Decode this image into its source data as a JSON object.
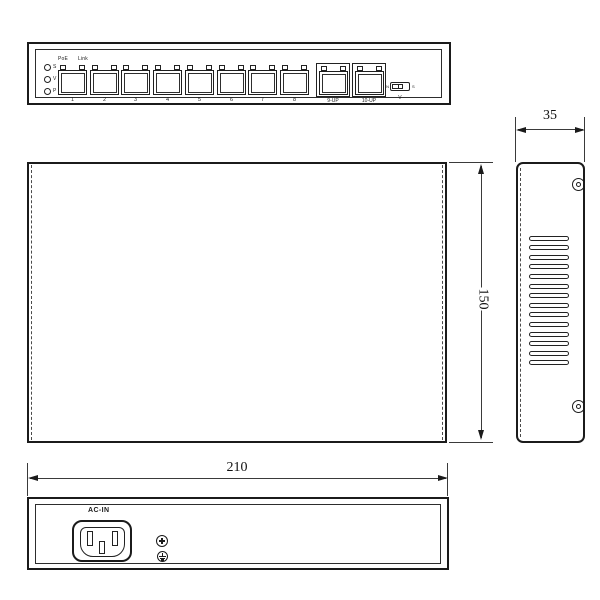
{
  "front_view": {
    "led_labels": [
      "S",
      "V",
      "P"
    ],
    "poe_label": "PoE",
    "link_label": "Link",
    "port_numbers": [
      "1",
      "2",
      "3",
      "4",
      "5",
      "6",
      "7",
      "8"
    ],
    "uplink_labels": [
      "9-UP",
      "10-UP"
    ],
    "switch": {
      "left_mark": "N",
      "right_mark": "S",
      "label": "V"
    }
  },
  "dimensions": {
    "side_width": "35",
    "top_depth": "150",
    "rear_width": "210"
  },
  "side_view": {
    "vent_slot_count": 14,
    "screw_hole_count": 2
  },
  "rear_view": {
    "ac_in_label": "AC-IN"
  }
}
